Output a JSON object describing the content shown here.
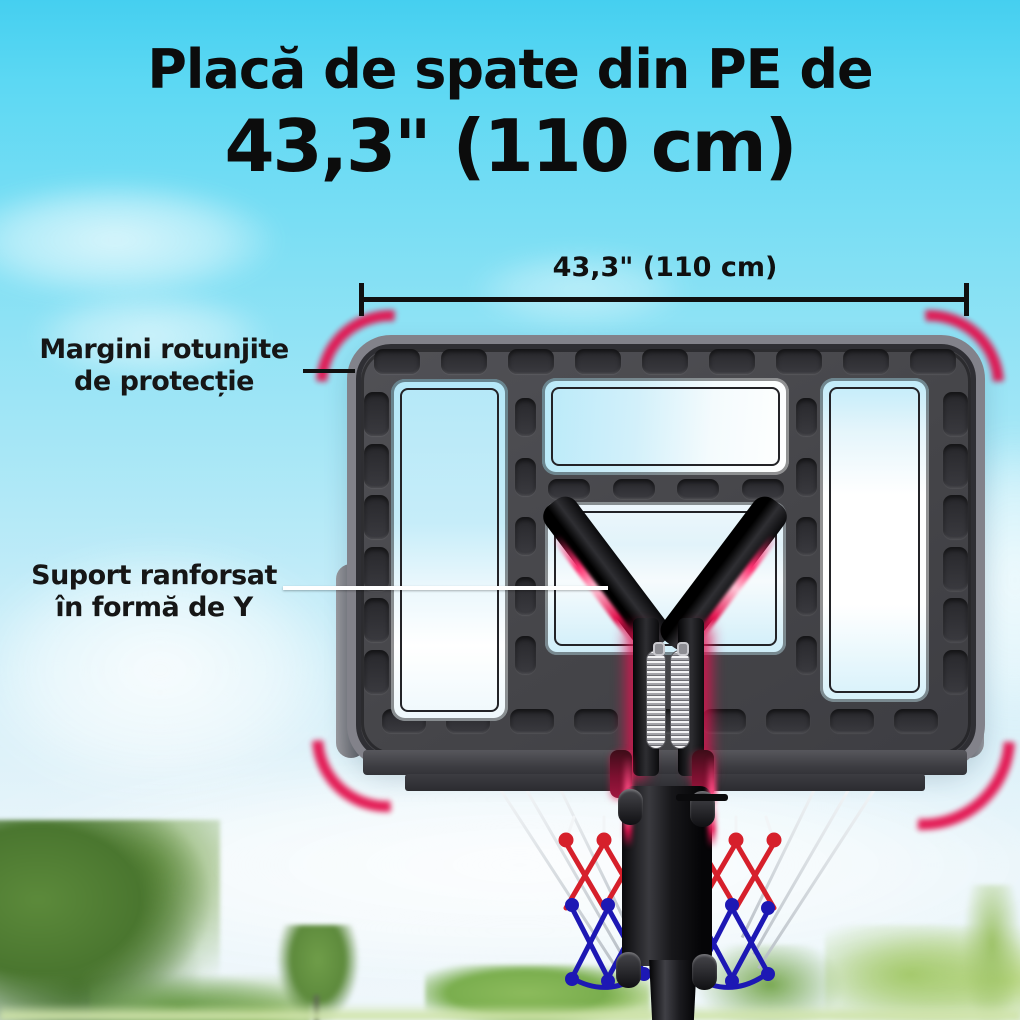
{
  "title": {
    "line1": "Placă de spate din PE de",
    "line2": "43,3\" (110 cm)"
  },
  "dimension": {
    "label": "43,3\" (110 cm)"
  },
  "annotations": {
    "rounded_edges": {
      "line1": "Margini rotunjite",
      "line2": "de protecție"
    },
    "y_support": {
      "line1": "Suport ranforsat",
      "line2": "în formă de Y"
    }
  },
  "colors": {
    "accent_red_glow": "#e3124e",
    "board_gray": "#47474b",
    "sky_top": "#45cff0",
    "sky_bottom": "#eff7fb",
    "net_red": "#d6202b",
    "net_blue": "#1d18b4",
    "foliage_green": "#6f9d49",
    "text_black": "#0c0c0c"
  }
}
